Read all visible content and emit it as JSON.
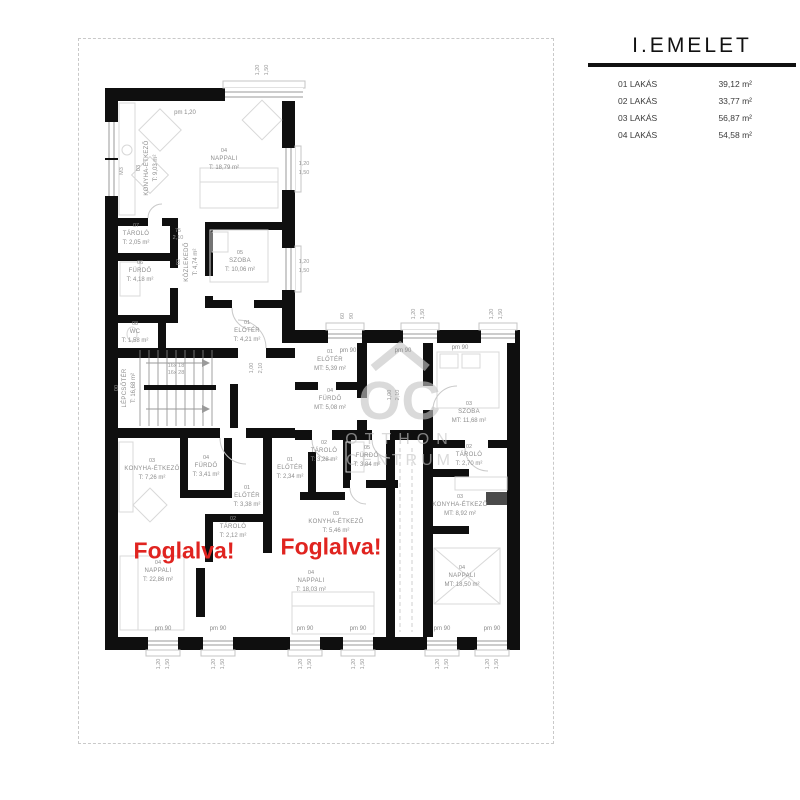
{
  "legend": {
    "title": "I.EMELET",
    "rows": [
      {
        "label": "01 LAKÁS",
        "area": "39,12 m²"
      },
      {
        "label": "02 LAKÁS",
        "area": "33,77 m²"
      },
      {
        "label": "03 LAKÁS",
        "area": "56,87 m²"
      },
      {
        "label": "04 LAKÁS",
        "area": "54,58 m²"
      }
    ]
  },
  "watermark": {
    "logo": "OC",
    "line1": "OTTHON",
    "line2": "CENTRUM"
  },
  "reserved_text": "Foglalva!",
  "colors": {
    "wall": "#0f0f0f",
    "reserved_red": "#e02420",
    "watermark_gray": "#c5c5c5"
  },
  "plan": {
    "rooms": [
      {
        "id": "03",
        "name": "KONYHA-ÉTKEZŐ",
        "area": "T: 9,03 m²",
        "x": 148,
        "y": 168,
        "rot": true
      },
      {
        "id": "04",
        "name": "NAPPALI",
        "area": "T: 18,79 m²",
        "x": 224,
        "y": 160,
        "rot": false
      },
      {
        "id": "07",
        "name": "TÁROLÓ",
        "area": "T: 2,05 m²",
        "x": 136,
        "y": 235,
        "rot": false
      },
      {
        "id": "06",
        "name": "FÜRDŐ",
        "area": "T: 4,18 m²",
        "x": 140,
        "y": 272,
        "rot": false
      },
      {
        "id": "02",
        "name": "KÖZLEKEDŐ",
        "area": "T: 4,74 m²",
        "x": 188,
        "y": 262,
        "rot": true
      },
      {
        "id": "05",
        "name": "SZOBA",
        "area": "T: 10,06 m²",
        "x": 240,
        "y": 262,
        "rot": false
      },
      {
        "id": "08",
        "name": "WC",
        "area": "T: 1,58 m²",
        "x": 135,
        "y": 333,
        "rot": false
      },
      {
        "id": "01",
        "name": "ELŐTÉR",
        "area": "T: 4,21 m²",
        "x": 247,
        "y": 332,
        "rot": false
      },
      {
        "id": "00",
        "name": "LÉPCSŐTÉR",
        "area": "T: 16,68 m²",
        "x": 126,
        "y": 388,
        "rot": true
      },
      {
        "id": "03",
        "name": "KONYHA-ÉTKEZŐ",
        "area": "T: 7,26 m²",
        "x": 152,
        "y": 470,
        "rot": false
      },
      {
        "id": "04",
        "name": "FÜRDŐ",
        "area": "T: 3,41 m²",
        "x": 206,
        "y": 467,
        "rot": false
      },
      {
        "id": "01",
        "name": "ELŐTÉR",
        "area": "T: 3,38 m²",
        "x": 247,
        "y": 497,
        "rot": false
      },
      {
        "id": "02",
        "name": "TÁROLÓ",
        "area": "T: 2,12 m²",
        "x": 233,
        "y": 528,
        "rot": false
      },
      {
        "id": "04",
        "name": "NAPPALI",
        "area": "T: 22,86 m²",
        "x": 158,
        "y": 572,
        "rot": false
      },
      {
        "id": "01",
        "name": "ELŐTÉR",
        "area": "T: 2,34 m²",
        "x": 290,
        "y": 469,
        "rot": false
      },
      {
        "id": "02",
        "name": "TÁROLÓ",
        "area": "T: 3,28 m²",
        "x": 324,
        "y": 452,
        "rot": false
      },
      {
        "id": "05",
        "name": "FÜRDŐ",
        "area": "T: 3,84 m²",
        "x": 367,
        "y": 457,
        "rot": false
      },
      {
        "id": "03",
        "name": "KONYHA-ÉTKEZŐ",
        "area": "T: 5,46 m²",
        "x": 336,
        "y": 523,
        "rot": false
      },
      {
        "id": "04",
        "name": "NAPPALI",
        "area": "T: 18,03 m²",
        "x": 311,
        "y": 582,
        "rot": false
      },
      {
        "id": "01",
        "name": "ELŐTÉR",
        "area": "MT: 5,39 m²",
        "x": 330,
        "y": 361,
        "rot": false
      },
      {
        "id": "04",
        "name": "FÜRDŐ",
        "area": "MT: 5,08 m²",
        "x": 330,
        "y": 400,
        "rot": false
      },
      {
        "id": "03",
        "name": "SZOBA",
        "area": "MT: 11,68 m²",
        "x": 469,
        "y": 413,
        "rot": false
      },
      {
        "id": "02",
        "name": "TÁROLÓ",
        "area": "T: 2,70 m²",
        "x": 469,
        "y": 456,
        "rot": false
      },
      {
        "id": "03",
        "name": "KONYHA-ÉTKEZŐ",
        "area": "MT: 8,92 m²",
        "x": 460,
        "y": 506,
        "rot": false
      },
      {
        "id": "04",
        "name": "NAPPALI",
        "area": "MT: 18,50 m²",
        "x": 462,
        "y": 577,
        "rot": false
      }
    ],
    "reserved": [
      {
        "x": 184,
        "y": 551
      },
      {
        "x": 331,
        "y": 547
      }
    ],
    "pm_labels": [
      {
        "t": "pm 1,20",
        "x": 185,
        "y": 113
      },
      {
        "t": "pm 90",
        "x": 348,
        "y": 351
      },
      {
        "t": "pm 90",
        "x": 403,
        "y": 351
      },
      {
        "t": "pm 90",
        "x": 460,
        "y": 348
      },
      {
        "t": "pm 90",
        "x": 163,
        "y": 629
      },
      {
        "t": "pm 90",
        "x": 218,
        "y": 629
      },
      {
        "t": "pm 90",
        "x": 305,
        "y": 629
      },
      {
        "t": "pm 90",
        "x": 358,
        "y": 629
      },
      {
        "t": "pm 90",
        "x": 442,
        "y": 629
      },
      {
        "t": "pm 90",
        "x": 492,
        "y": 629
      }
    ],
    "dims": [
      {
        "t": "1,20",
        "x": 258,
        "y": 70,
        "r": true
      },
      {
        "t": "1,50",
        "x": 267,
        "y": 70,
        "r": true
      },
      {
        "t": "1,20",
        "x": 304,
        "y": 164,
        "r": false
      },
      {
        "t": "1,50",
        "x": 304,
        "y": 173,
        "r": false
      },
      {
        "t": "1,20",
        "x": 304,
        "y": 262,
        "r": false
      },
      {
        "t": "1,50",
        "x": 304,
        "y": 271,
        "r": false
      },
      {
        "t": "60",
        "x": 343,
        "y": 316,
        "r": true
      },
      {
        "t": "90",
        "x": 352,
        "y": 316,
        "r": true
      },
      {
        "t": "1,20",
        "x": 414,
        "y": 314,
        "r": true
      },
      {
        "t": "1,50",
        "x": 423,
        "y": 314,
        "r": true
      },
      {
        "t": "1,20",
        "x": 492,
        "y": 314,
        "r": true
      },
      {
        "t": "1,50",
        "x": 501,
        "y": 314,
        "r": true
      },
      {
        "t": "1,20",
        "x": 159,
        "y": 664,
        "r": true
      },
      {
        "t": "1,50",
        "x": 168,
        "y": 664,
        "r": true
      },
      {
        "t": "1,20",
        "x": 214,
        "y": 664,
        "r": true
      },
      {
        "t": "1,50",
        "x": 223,
        "y": 664,
        "r": true
      },
      {
        "t": "1,20",
        "x": 301,
        "y": 664,
        "r": true
      },
      {
        "t": "1,50",
        "x": 310,
        "y": 664,
        "r": true
      },
      {
        "t": "1,20",
        "x": 354,
        "y": 664,
        "r": true
      },
      {
        "t": "1,50",
        "x": 363,
        "y": 664,
        "r": true
      },
      {
        "t": "1,20",
        "x": 438,
        "y": 664,
        "r": true
      },
      {
        "t": "1,50",
        "x": 447,
        "y": 664,
        "r": true
      },
      {
        "t": "1,20",
        "x": 488,
        "y": 664,
        "r": true
      },
      {
        "t": "1,50",
        "x": 497,
        "y": 664,
        "r": true
      },
      {
        "t": "75",
        "x": 178,
        "y": 231,
        "r": false
      },
      {
        "t": "2,10",
        "x": 178,
        "y": 238,
        "r": false
      },
      {
        "t": "1,00",
        "x": 252,
        "y": 368,
        "r": true
      },
      {
        "t": "2,10",
        "x": 261,
        "y": 368,
        "r": true
      },
      {
        "t": "1,00",
        "x": 390,
        "y": 395,
        "r": true
      },
      {
        "t": "2,10",
        "x": 398,
        "y": 395,
        "r": true
      },
      {
        "t": "16x 18",
        "x": 176,
        "y": 366,
        "r": false
      },
      {
        "t": "16x 28",
        "x": 176,
        "y": 373,
        "r": false
      },
      {
        "t": "M3",
        "x": 122,
        "y": 171,
        "r": true
      }
    ]
  }
}
